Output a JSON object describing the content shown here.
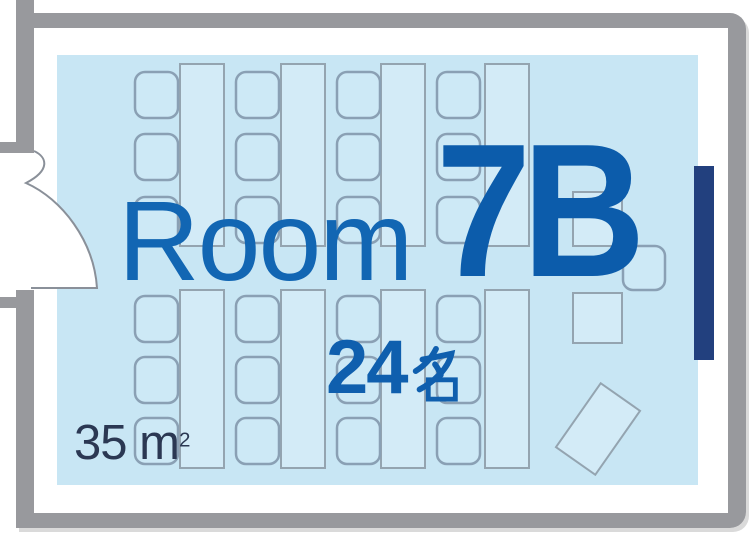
{
  "room": {
    "label": "Room",
    "number": "7B"
  },
  "capacity": {
    "value": "24",
    "unit": "名",
    "text": "24名"
  },
  "area": {
    "value": "35",
    "unit": "m",
    "superscript": "2",
    "text": "35 m²"
  },
  "colors": {
    "wall_gray": "#98999d",
    "floor_blue": "#c8e6f4",
    "table_fill": "#d3ebf7",
    "chair_fill": "#cde9f6",
    "furniture_outline": "#8aa0b4",
    "screen_navy": "#22407e",
    "title_blue": "#1266b3",
    "number_blue": "#0c5cab",
    "capacity_blue": "#0f5fae",
    "area_text": "#2b3853"
  },
  "furniture": {
    "total_seats": 24,
    "long_tables": 8,
    "table_w": 44,
    "chair_w": 43,
    "chair_h": 46,
    "chair_r": 10,
    "columns": [
      {
        "chair_x": 135,
        "table_x": 180
      },
      {
        "chair_x": 236,
        "table_x": 281
      },
      {
        "chair_x": 337,
        "table_x": 381
      },
      {
        "chair_x": 437,
        "table_x": 485
      }
    ],
    "banks": [
      {
        "table_y": 64,
        "table_h": 182,
        "chair_rows": [
          72,
          134,
          197
        ]
      },
      {
        "table_y": 290,
        "table_h": 178,
        "chair_rows": [
          296,
          357,
          418
        ]
      }
    ],
    "extras": {
      "presenter_desk_top": {
        "x": 573,
        "y": 192,
        "w": 49,
        "h": 54
      },
      "presenter_chair": {
        "x": 623,
        "y": 246,
        "w": 42,
        "h": 44
      },
      "presenter_desk_mid": {
        "x": 573,
        "y": 293,
        "w": 49,
        "h": 50
      },
      "tilted_desk": {
        "x": 574,
        "y": 390,
        "w": 48,
        "h": 78,
        "rotate": 35,
        "cx": 598,
        "cy": 429
      }
    }
  }
}
